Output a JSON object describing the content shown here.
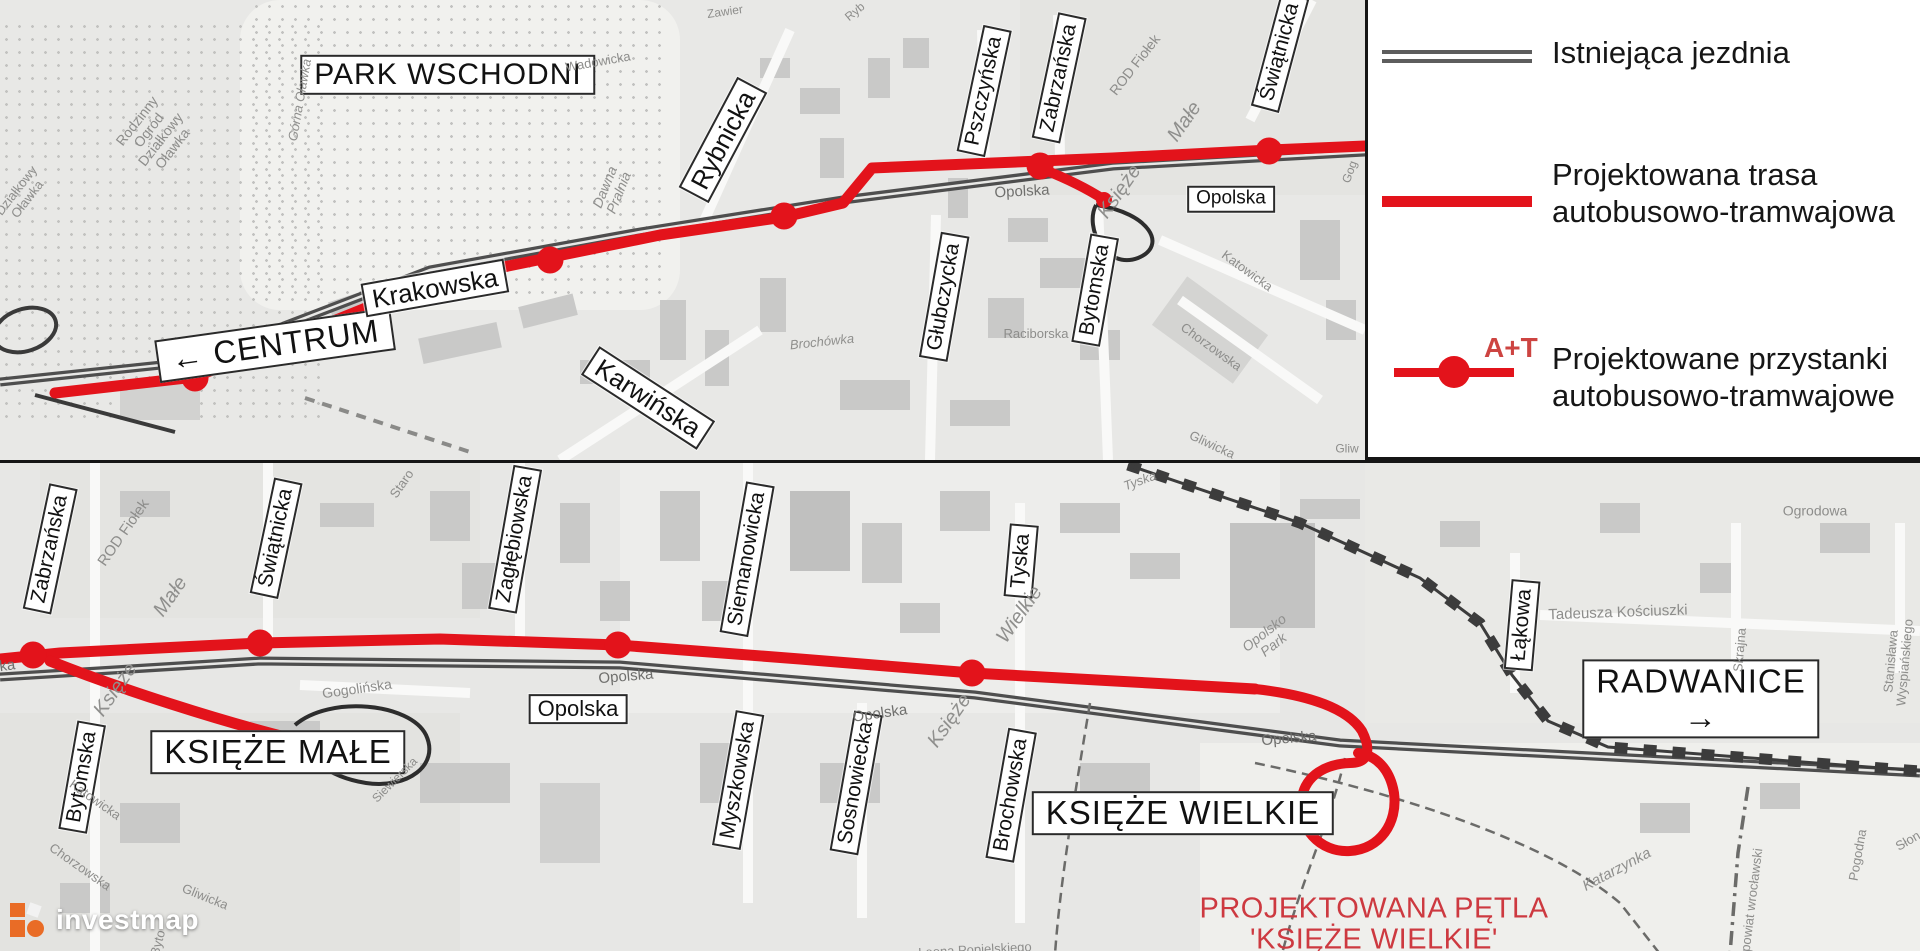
{
  "colors": {
    "route_red": "#e3131b",
    "caption_red": "#cd3940",
    "at_red": "#cd4441",
    "existing_road_gray": "#5d5d5d",
    "watermark_orange": "#e96c26"
  },
  "legend": {
    "items": [
      {
        "name": "existing-road",
        "label": "Istniejąca jezdnia"
      },
      {
        "name": "planned-route",
        "label_line1": "Projektowana trasa",
        "label_line2": "autobusowo-tramwajowa"
      },
      {
        "name": "planned-stops",
        "symbol": "A+T",
        "label_line1": "Projektowane przystanki",
        "label_line2": "autobusowo-tramwajowe"
      }
    ]
  },
  "watermark": {
    "text": "investmap"
  },
  "top_map": {
    "stops": [
      [
        195,
        378
      ],
      [
        550,
        260
      ],
      [
        784,
        216
      ],
      [
        1040,
        166
      ],
      [
        1269,
        151
      ]
    ],
    "labels": [
      {
        "t": "PARK WSCHODNI",
        "x": 448,
        "y": 75,
        "r": 0,
        "s": 30,
        "c": "boxL",
        "n": "area-label-park-wschodni"
      },
      {
        "t": "← CENTRUM",
        "x": 275,
        "y": 345,
        "r": -8,
        "s": 32,
        "c": "boxL",
        "n": "direction-label-centrum"
      },
      {
        "t": "Krakowska",
        "x": 435,
        "y": 288,
        "r": -10,
        "s": 26,
        "c": "box",
        "n": "street-label-krakowska"
      },
      {
        "t": "Rybnicka",
        "x": 723,
        "y": 140,
        "r": -62,
        "s": 26,
        "c": "box",
        "n": "street-label-rybnicka"
      },
      {
        "t": "Karwińska",
        "x": 648,
        "y": 398,
        "r": 33,
        "s": 26,
        "c": "box",
        "n": "street-label-karwinska"
      },
      {
        "t": "Pszczyńska",
        "x": 984,
        "y": 91,
        "r": -78,
        "s": 21,
        "c": "box",
        "n": "street-label-pszczynska"
      },
      {
        "t": "Zabrzańska",
        "x": 1059,
        "y": 78,
        "r": -78,
        "s": 21,
        "c": "box",
        "n": "street-label-zabrzanska"
      },
      {
        "t": "Świątnicka",
        "x": 1280,
        "y": 52,
        "r": -75,
        "s": 21,
        "c": "box",
        "n": "street-label-swiatnicka"
      },
      {
        "t": "Głubczycka",
        "x": 944,
        "y": 297,
        "r": -80,
        "s": 21,
        "c": "box",
        "n": "street-label-glubczycka"
      },
      {
        "t": "Bytomska",
        "x": 1095,
        "y": 290,
        "r": -80,
        "s": 21,
        "c": "box",
        "n": "street-label-bytomska"
      },
      {
        "t": "Opolska",
        "x": 1231,
        "y": 199,
        "r": 0,
        "s": 19,
        "c": "box",
        "n": "street-label-opolska"
      },
      {
        "t": "Rodzinny\nOgród\nDziałkowy\nOławka",
        "x": 155,
        "y": 135,
        "r": -52,
        "s": 14,
        "c": "g",
        "n": "minor-label-rod-olawka"
      },
      {
        "t": "Działkowy\nOławka",
        "x": 22,
        "y": 195,
        "r": -52,
        "s": 13,
        "c": "g",
        "n": "minor-label-olawka-fragment"
      },
      {
        "t": "Górna Oławka",
        "x": 300,
        "y": 100,
        "r": -80,
        "s": 13,
        "c": "gi",
        "n": "minor-label-gorna-olawka"
      },
      {
        "t": "Dawna\nPralnia",
        "x": 612,
        "y": 190,
        "r": -68,
        "s": 14,
        "c": "gi",
        "n": "minor-label-dawna-pralnia"
      },
      {
        "t": "Wadowicka",
        "x": 598,
        "y": 62,
        "r": -10,
        "s": 13,
        "c": "g",
        "n": "minor-label-wadowicka"
      },
      {
        "t": "Zawier",
        "x": 725,
        "y": 12,
        "r": -8,
        "s": 12,
        "c": "g",
        "n": "minor-label-zawier"
      },
      {
        "t": "Ryb",
        "x": 855,
        "y": 12,
        "r": -40,
        "s": 12,
        "c": "g",
        "n": "minor-label-ryb"
      },
      {
        "t": "ROD Fiołek",
        "x": 1135,
        "y": 65,
        "r": -52,
        "s": 14,
        "c": "g",
        "n": "minor-label-rod-fiolek"
      },
      {
        "t": "Małe",
        "x": 1185,
        "y": 122,
        "r": -55,
        "s": 20,
        "c": "gi",
        "n": "minor-label-ksieze-male-2"
      },
      {
        "t": "Księże",
        "x": 1120,
        "y": 192,
        "r": -55,
        "s": 20,
        "c": "gi",
        "n": "minor-label-ksieze-male-1"
      },
      {
        "t": "Opolska",
        "x": 1022,
        "y": 192,
        "r": -3,
        "s": 15,
        "c": "gd",
        "n": "road-label-opolska-gray"
      },
      {
        "t": "Raciborska",
        "x": 1036,
        "y": 334,
        "r": 0,
        "s": 13,
        "c": "g",
        "n": "minor-label-raciborska"
      },
      {
        "t": "Katowicka",
        "x": 1247,
        "y": 271,
        "r": 36,
        "s": 13,
        "c": "g",
        "n": "minor-label-katowicka"
      },
      {
        "t": "Chorzowska",
        "x": 1211,
        "y": 347,
        "r": 36,
        "s": 13,
        "c": "g",
        "n": "minor-label-chorzowska"
      },
      {
        "t": "Gliwicka",
        "x": 1212,
        "y": 445,
        "r": 25,
        "s": 13,
        "c": "g",
        "n": "minor-label-gliwicka"
      },
      {
        "t": "Brochówka",
        "x": 822,
        "y": 342,
        "r": -6,
        "s": 13,
        "c": "gi",
        "n": "minor-label-brochowka"
      },
      {
        "t": "Gliw",
        "x": 1347,
        "y": 449,
        "r": 0,
        "s": 12,
        "c": "g",
        "n": "minor-label-gliw"
      },
      {
        "t": "Gog",
        "x": 1350,
        "y": 172,
        "r": -70,
        "s": 12,
        "c": "g",
        "n": "minor-label-gog"
      }
    ]
  },
  "bottom_map": {
    "stops": [
      [
        33,
        192
      ],
      [
        260,
        180
      ],
      [
        618,
        182
      ],
      [
        972,
        210
      ]
    ],
    "labels": [
      {
        "t": "Zabrzańska",
        "x": 50,
        "y": 86,
        "r": -78,
        "s": 21,
        "c": "box",
        "n": "street-label-zabrzanska-2"
      },
      {
        "t": "Świątnicka",
        "x": 276,
        "y": 75,
        "r": -78,
        "s": 21,
        "c": "box",
        "n": "street-label-swiatnicka-2"
      },
      {
        "t": "Zagłębiowska",
        "x": 515,
        "y": 76,
        "r": -80,
        "s": 21,
        "c": "box",
        "n": "street-label-zaglebiowska"
      },
      {
        "t": "Siemanowicka",
        "x": 747,
        "y": 96,
        "r": -80,
        "s": 21,
        "c": "box",
        "n": "street-label-siemanowicka"
      },
      {
        "t": "Tyska",
        "x": 1021,
        "y": 98,
        "r": -85,
        "s": 21,
        "c": "box",
        "n": "street-label-tyska"
      },
      {
        "t": "Łąkowa",
        "x": 1522,
        "y": 162,
        "r": -85,
        "s": 21,
        "c": "box",
        "n": "street-label-lakowa"
      },
      {
        "t": "Bytomska",
        "x": 82,
        "y": 314,
        "r": -80,
        "s": 21,
        "c": "box",
        "n": "street-label-bytomska-2"
      },
      {
        "t": "Myszkowska",
        "x": 738,
        "y": 317,
        "r": -80,
        "s": 21,
        "c": "box",
        "n": "street-label-myszkowska"
      },
      {
        "t": "Sosnowiecka",
        "x": 856,
        "y": 320,
        "r": -80,
        "s": 21,
        "c": "box",
        "n": "street-label-sosnowiecka"
      },
      {
        "t": "Brochowska",
        "x": 1011,
        "y": 332,
        "r": -80,
        "s": 21,
        "c": "box",
        "n": "street-label-brochowska"
      },
      {
        "t": "Opolska",
        "x": 578,
        "y": 246,
        "r": 0,
        "s": 22,
        "c": "box",
        "n": "street-label-opolska-2"
      },
      {
        "t": "KSIĘŻE MAŁE",
        "x": 278,
        "y": 289,
        "r": 0,
        "s": 33,
        "c": "boxL",
        "n": "area-label-ksieze-male"
      },
      {
        "t": "KSIĘŻE WIELKIE",
        "x": 1183,
        "y": 350,
        "r": 0,
        "s": 33,
        "c": "boxL",
        "n": "area-label-ksieze-wielkie"
      },
      {
        "t": "RADWANICE →",
        "x": 1701,
        "y": 236,
        "r": 0,
        "s": 33,
        "c": "boxL",
        "n": "direction-label-radwanice"
      },
      {
        "t": "PROJEKTOWANA PĘTLA\n'KSIĘŻE WIELKIE'",
        "x": 1374,
        "y": 462,
        "r": 0,
        "s": 29,
        "c": "red",
        "n": "caption-projektowana-petla"
      },
      {
        "t": "ROD Fiołek",
        "x": 124,
        "y": 70,
        "r": -55,
        "s": 15,
        "c": "g",
        "n": "minor-label-rod-fiolek-2"
      },
      {
        "t": "Małe",
        "x": 171,
        "y": 134,
        "r": -55,
        "s": 20,
        "c": "gi",
        "n": "minor-label-ksieze-male-4"
      },
      {
        "t": "Księże",
        "x": 116,
        "y": 227,
        "r": -55,
        "s": 20,
        "c": "gi",
        "n": "minor-label-ksieze-male-3"
      },
      {
        "t": "Wielkie",
        "x": 1020,
        "y": 152,
        "r": -55,
        "s": 20,
        "c": "gi",
        "n": "minor-label-ksieze-wielkie-2"
      },
      {
        "t": "Księże",
        "x": 950,
        "y": 258,
        "r": -55,
        "s": 20,
        "c": "gi",
        "n": "minor-label-ksieze-wielkie-1"
      },
      {
        "t": "Staro",
        "x": 402,
        "y": 21,
        "r": -55,
        "s": 13,
        "c": "g",
        "n": "minor-label-staro"
      },
      {
        "t": "Opolska",
        "x": -12,
        "y": 206,
        "r": -8,
        "s": 15,
        "c": "gd",
        "n": "road-label-opolska-b1"
      },
      {
        "t": "Opolska",
        "x": 626,
        "y": 214,
        "r": -5,
        "s": 15,
        "c": "gd",
        "n": "road-label-opolska-b2"
      },
      {
        "t": "Opolska",
        "x": 880,
        "y": 251,
        "r": -8,
        "s": 15,
        "c": "gd",
        "n": "road-label-opolska-b3"
      },
      {
        "t": "Opolska",
        "x": 1289,
        "y": 276,
        "r": -5,
        "s": 15,
        "c": "gd",
        "n": "road-label-opolska-b4"
      },
      {
        "t": "Gogolińska",
        "x": 357,
        "y": 226,
        "r": -8,
        "s": 14,
        "c": "g",
        "n": "minor-label-gogolinska"
      },
      {
        "t": "Siewierska",
        "x": 395,
        "y": 317,
        "r": -45,
        "s": 12,
        "c": "g",
        "n": "minor-label-siewierska"
      },
      {
        "t": "Opolsko\nPark",
        "x": 1269,
        "y": 176,
        "r": -38,
        "s": 14,
        "c": "gi",
        "n": "minor-label-opolsko-park"
      },
      {
        "t": "Tyska",
        "x": 1140,
        "y": 18,
        "r": -20,
        "s": 13,
        "c": "gi",
        "n": "minor-label-tyska-gray"
      },
      {
        "t": "Tadeusza Kościuszki",
        "x": 1618,
        "y": 150,
        "r": -2,
        "s": 15,
        "c": "g",
        "n": "minor-label-tadeusza-kosciuszki"
      },
      {
        "t": "Ogrodowa",
        "x": 1815,
        "y": 48,
        "r": 0,
        "s": 14,
        "c": "g",
        "n": "minor-label-ogrodowa"
      },
      {
        "t": "Skrajna",
        "x": 1740,
        "y": 187,
        "r": -85,
        "s": 13,
        "c": "g",
        "n": "minor-label-skrajna"
      },
      {
        "t": "Stanisława Wyspiańskiego",
        "x": 1898,
        "y": 199,
        "r": -85,
        "s": 13,
        "c": "g",
        "n": "minor-label-wyspianskiego"
      },
      {
        "t": "Pogodna",
        "x": 1858,
        "y": 392,
        "r": -80,
        "s": 13,
        "c": "g",
        "n": "minor-label-pogodna"
      },
      {
        "t": "Katarzynka",
        "x": 1617,
        "y": 407,
        "r": -28,
        "s": 15,
        "c": "gi",
        "n": "minor-label-katarzynka"
      },
      {
        "t": "powiat wrocławski",
        "x": 1752,
        "y": 437,
        "r": -83,
        "s": 13,
        "c": "g",
        "n": "minor-label-powiat-wroclawski"
      },
      {
        "t": "Słon",
        "x": 1908,
        "y": 378,
        "r": -30,
        "s": 13,
        "c": "g",
        "n": "minor-label-slon"
      },
      {
        "t": "Leona Popielskiego",
        "x": 975,
        "y": 487,
        "r": -3,
        "s": 13,
        "c": "g",
        "n": "minor-label-leona-popielskiego"
      },
      {
        "t": "Katowicka",
        "x": 95,
        "y": 337,
        "r": 35,
        "s": 13,
        "c": "g",
        "n": "minor-label-katowicka-2"
      },
      {
        "t": "Chorzowska",
        "x": 80,
        "y": 404,
        "r": 35,
        "s": 13,
        "c": "g",
        "n": "minor-label-chorzowska-2"
      },
      {
        "t": "Gliwicka",
        "x": 205,
        "y": 434,
        "r": 22,
        "s": 13,
        "c": "g",
        "n": "minor-label-gliwicka-2"
      },
      {
        "t": "Byto",
        "x": 158,
        "y": 480,
        "r": -75,
        "s": 13,
        "c": "g",
        "n": "minor-label-byto"
      }
    ]
  }
}
